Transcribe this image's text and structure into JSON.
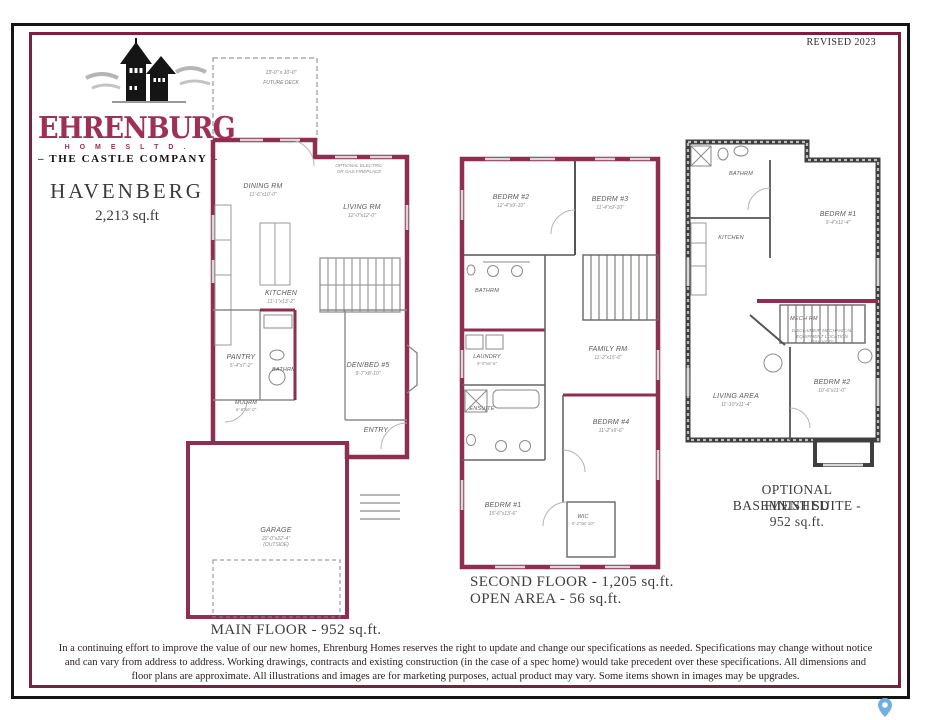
{
  "frame": {
    "revised": "REVISED 2023"
  },
  "brand": {
    "name": "EHRENBURG",
    "homes_ltd": "H O M E S   L T D .",
    "tagline": "– THE CASTLE COMPANY –",
    "model": "HAVENBERG",
    "area": "2,213 sq.ft"
  },
  "colors": {
    "maroon_wall": "#8e2e50",
    "frame_maroon": "#7c2040",
    "pin_blue": "#6fb0e4"
  },
  "main_floor": {
    "caption": "MAIN FLOOR - 952 sq.ft.",
    "deck_dims": "13'-0\" x 10'-0\"",
    "deck_name": "FUTURE DECK",
    "dining_name": "DINING RM",
    "dining_dims": "11'-6\"x10'-0\"",
    "living_name": "LIVING RM",
    "living_dims": "12'-0\"x12'-0\"",
    "fireplace_note": "OPTIONAL ELECTRIC OR GAS FIREPLACE",
    "kitchen_name": "KITCHEN",
    "kitchen_dims": "11'-1\"x13'-2\"",
    "pantry_name": "PANTRY",
    "pantry_dims": "5'-4\"x7'-2\"",
    "bath_name": "BATHRM",
    "mud_name": "MUDRM",
    "mud_dims": "6'-6\"x6'-0\"",
    "den_name": "DEN/BED #5",
    "den_dims": "9'-7\"x8'-10\"",
    "entry_name": "ENTRY",
    "garage_name": "GARAGE",
    "garage_dims": "22'-0\"x22'-4\"",
    "garage_note": "(OUTSIDE)"
  },
  "second_floor": {
    "caption1": "SECOND FLOOR - 1,205 sq.ft.",
    "caption2": "OPEN AREA - 56 sq.ft.",
    "bedrm2_name": "BEDRM #2",
    "bedrm2_dims": "12'-4\"x9'-10\"",
    "bedrm3_name": "BEDRM #3",
    "bedrm3_dims": "11'-4\"x9'-10\"",
    "bath_name": "BATHRM",
    "laundry_name": "LAUNDRY",
    "laundry_dims": "9'-0\"x6'-6\"",
    "ensuite_name": "ENSUITE",
    "family_name": "FAMILY RM",
    "family_dims": "11'-2\"x15'-6\"",
    "bedrm4_name": "BEDRM #4",
    "bedrm4_dims": "11'-2\"x9'-6\"",
    "bedrm1_name": "BEDRM #1",
    "bedrm1_dims": "15'-6\"x13'-6\"",
    "wic_name": "WIC",
    "wic_dims": "5'-2\"x8'-10\""
  },
  "basement": {
    "caption1": "OPTIONAL FINISHED",
    "caption2": "BASEMENT SUITE - 952 sq.ft.",
    "bath_name": "BATHRM",
    "kitchen_name": "KITCHEN",
    "bedrm1_name": "BEDRM #1",
    "bedrm1_dims": "9'-4\"x11'-4\"",
    "mech_name": "MECH RM",
    "mech_note": "DISCLAIMER: MECHANICAL EQUIPMENT LOCATION MAY VARY",
    "living_name": "LIVING AREA",
    "living_dims": "11'-10\"x11'-4\"",
    "bedrm2_name": "BEDRM #2",
    "bedrm2_dims": "10'-6\"x11'-0\""
  },
  "disclaimer": "In a continuing effort to improve the value of our new homes, Ehrenburg Homes reserves the right to update and change our specifications as needed. Specifications may change without notice and can vary from address to address. Working drawings, contracts and existing construction (in the case of a spec home) would take precedent over these specifications. All dimensions and floor plans are approximate. All illustrations and images are for marketing purposes, actual product may vary. Some items shown in images may be upgrades."
}
